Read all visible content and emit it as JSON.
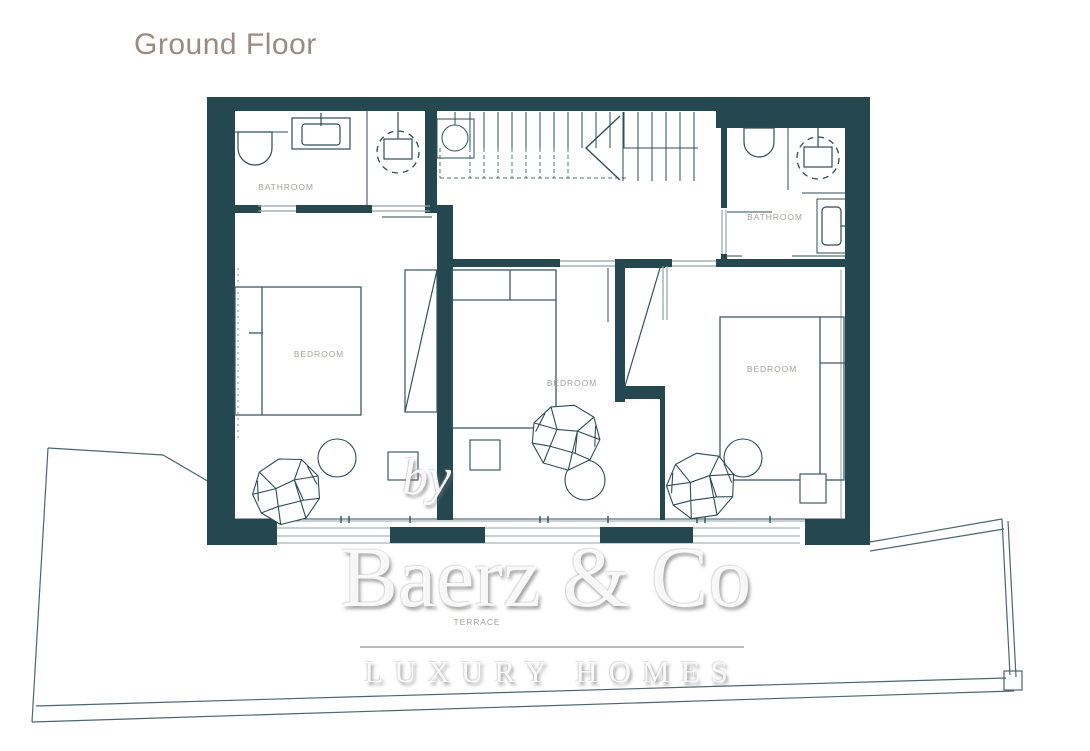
{
  "page": {
    "title": "Ground Floor"
  },
  "plan": {
    "rooms": [
      {
        "id": "bathroom-left",
        "label": "BATHROOM"
      },
      {
        "id": "bathroom-right",
        "label": "BATHROOM"
      },
      {
        "id": "bedroom-left",
        "label": "BEDROOM"
      },
      {
        "id": "bedroom-middle",
        "label": "BEDROOM"
      },
      {
        "id": "bedroom-right",
        "label": "BEDROOM"
      },
      {
        "id": "terrace",
        "label": "TERRACE"
      }
    ],
    "colors": {
      "wall": "#254750",
      "interior_line": "#2e4f59",
      "light_line": "#8fa3a9",
      "room_label": "#a8a09b",
      "title": "#9a8b81"
    }
  },
  "watermark": {
    "prefix": "by",
    "brand": "Baerz & Co",
    "tagline": "LUXURY HOMES"
  }
}
